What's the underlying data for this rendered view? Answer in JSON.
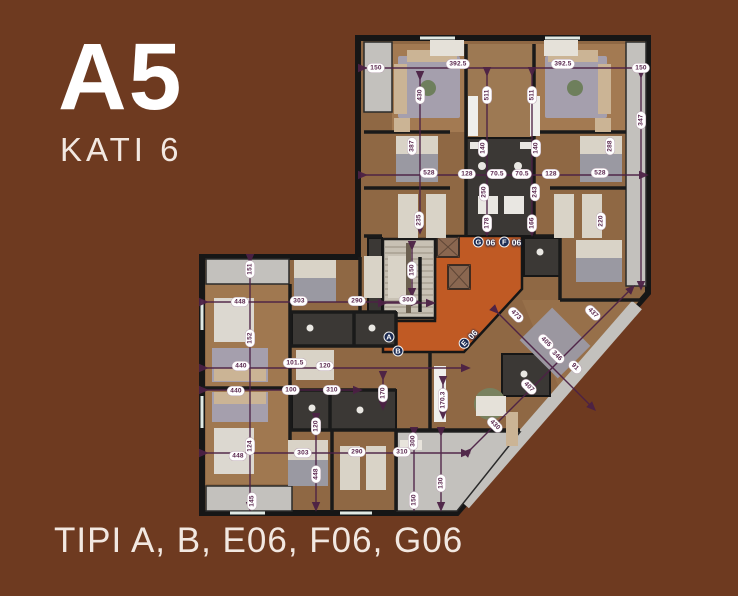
{
  "header": {
    "block_label": "A5",
    "floor_label": "KATI 6"
  },
  "footer": {
    "caption": "TIPI A, B, E06, F06, G06"
  },
  "colors": {
    "background": "#6e3a20",
    "corridor_orange": "#c05a24",
    "badge_navy": "#1c2b52",
    "dimension_purple": "#4c2145",
    "wall_dark": "#1a1a1a",
    "floor_wood": "#8f6844",
    "balcony_gray": "#c3c1bd"
  },
  "plan": {
    "unit_badges": [
      {
        "letter": "G",
        "number": "06",
        "x": 484,
        "y": 242,
        "rot": 0
      },
      {
        "letter": "F",
        "number": "06",
        "x": 510,
        "y": 242,
        "rot": 0
      },
      {
        "letter": "E",
        "number": "06",
        "x": 468,
        "y": 339,
        "rot": -48
      },
      {
        "letter": "A",
        "number": "",
        "x": 389,
        "y": 337,
        "rot": 0
      },
      {
        "letter": "B",
        "number": "",
        "x": 398,
        "y": 351,
        "rot": 0
      }
    ],
    "dimensions": [
      {
        "value": "150",
        "x": 376,
        "y": 68,
        "rot": 0
      },
      {
        "value": "392.5",
        "x": 458,
        "y": 64,
        "rot": 0
      },
      {
        "value": "392.5",
        "x": 563,
        "y": 64,
        "rot": 0
      },
      {
        "value": "150",
        "x": 641,
        "y": 68,
        "rot": 0
      },
      {
        "value": "430",
        "x": 420,
        "y": 95,
        "rot": -90
      },
      {
        "value": "511",
        "x": 487,
        "y": 95,
        "rot": -90
      },
      {
        "value": "511",
        "x": 532,
        "y": 95,
        "rot": -90
      },
      {
        "value": "347",
        "x": 641,
        "y": 120,
        "rot": -90
      },
      {
        "value": "387",
        "x": 412,
        "y": 146,
        "rot": -90
      },
      {
        "value": "288",
        "x": 610,
        "y": 146,
        "rot": -90
      },
      {
        "value": "528",
        "x": 429,
        "y": 173,
        "rot": 0
      },
      {
        "value": "128",
        "x": 467,
        "y": 174,
        "rot": 0
      },
      {
        "value": "70.5",
        "x": 497,
        "y": 174,
        "rot": 0
      },
      {
        "value": "70.5",
        "x": 522,
        "y": 174,
        "rot": 0
      },
      {
        "value": "128",
        "x": 551,
        "y": 174,
        "rot": 0
      },
      {
        "value": "528",
        "x": 600,
        "y": 173,
        "rot": 0
      },
      {
        "value": "140",
        "x": 483,
        "y": 148,
        "rot": -90
      },
      {
        "value": "140",
        "x": 536,
        "y": 148,
        "rot": -90
      },
      {
        "value": "250",
        "x": 484,
        "y": 192,
        "rot": -90
      },
      {
        "value": "243",
        "x": 535,
        "y": 192,
        "rot": -90
      },
      {
        "value": "178",
        "x": 487,
        "y": 223,
        "rot": -90
      },
      {
        "value": "166",
        "x": 532,
        "y": 223,
        "rot": -90
      },
      {
        "value": "235",
        "x": 419,
        "y": 220,
        "rot": -90
      },
      {
        "value": "220",
        "x": 601,
        "y": 221,
        "rot": -90
      },
      {
        "value": "300",
        "x": 408,
        "y": 300,
        "rot": 0
      },
      {
        "value": "150",
        "x": 412,
        "y": 270,
        "rot": -90
      },
      {
        "value": "151",
        "x": 250,
        "y": 269,
        "rot": -90
      },
      {
        "value": "448",
        "x": 240,
        "y": 302,
        "rot": 0
      },
      {
        "value": "303",
        "x": 299,
        "y": 301,
        "rot": 0
      },
      {
        "value": "290",
        "x": 357,
        "y": 301,
        "rot": 0
      },
      {
        "value": "152",
        "x": 250,
        "y": 338,
        "rot": -90
      },
      {
        "value": "440",
        "x": 241,
        "y": 366,
        "rot": 0
      },
      {
        "value": "101.5",
        "x": 295,
        "y": 363,
        "rot": 0
      },
      {
        "value": "120",
        "x": 325,
        "y": 366,
        "rot": 0
      },
      {
        "value": "440",
        "x": 236,
        "y": 391,
        "rot": 0
      },
      {
        "value": "100",
        "x": 291,
        "y": 390,
        "rot": 0
      },
      {
        "value": "310",
        "x": 332,
        "y": 390,
        "rot": 0
      },
      {
        "value": "170",
        "x": 383,
        "y": 393,
        "rot": -90
      },
      {
        "value": "124",
        "x": 250,
        "y": 446,
        "rot": -90
      },
      {
        "value": "448",
        "x": 238,
        "y": 456,
        "rot": 0
      },
      {
        "value": "303",
        "x": 303,
        "y": 453,
        "rot": 0
      },
      {
        "value": "290",
        "x": 357,
        "y": 452,
        "rot": 0
      },
      {
        "value": "310",
        "x": 402,
        "y": 452,
        "rot": 0
      },
      {
        "value": "145",
        "x": 252,
        "y": 501,
        "rot": -90
      },
      {
        "value": "120",
        "x": 316,
        "y": 426,
        "rot": -90
      },
      {
        "value": "448",
        "x": 316,
        "y": 474,
        "rot": -90
      },
      {
        "value": "300",
        "x": 413,
        "y": 441,
        "rot": -90
      },
      {
        "value": "150",
        "x": 414,
        "y": 500,
        "rot": -90
      },
      {
        "value": "130",
        "x": 441,
        "y": 483,
        "rot": -90
      },
      {
        "value": "170.3",
        "x": 443,
        "y": 400,
        "rot": -90
      },
      {
        "value": "473",
        "x": 516,
        "y": 315,
        "rot": 45
      },
      {
        "value": "437",
        "x": 593,
        "y": 313,
        "rot": 45
      },
      {
        "value": "405",
        "x": 546,
        "y": 342,
        "rot": 45
      },
      {
        "value": "346",
        "x": 557,
        "y": 356,
        "rot": 45
      },
      {
        "value": "91",
        "x": 575,
        "y": 367,
        "rot": 45
      },
      {
        "value": "407",
        "x": 529,
        "y": 387,
        "rot": 45
      },
      {
        "value": "430",
        "x": 495,
        "y": 425,
        "rot": 45
      }
    ]
  }
}
